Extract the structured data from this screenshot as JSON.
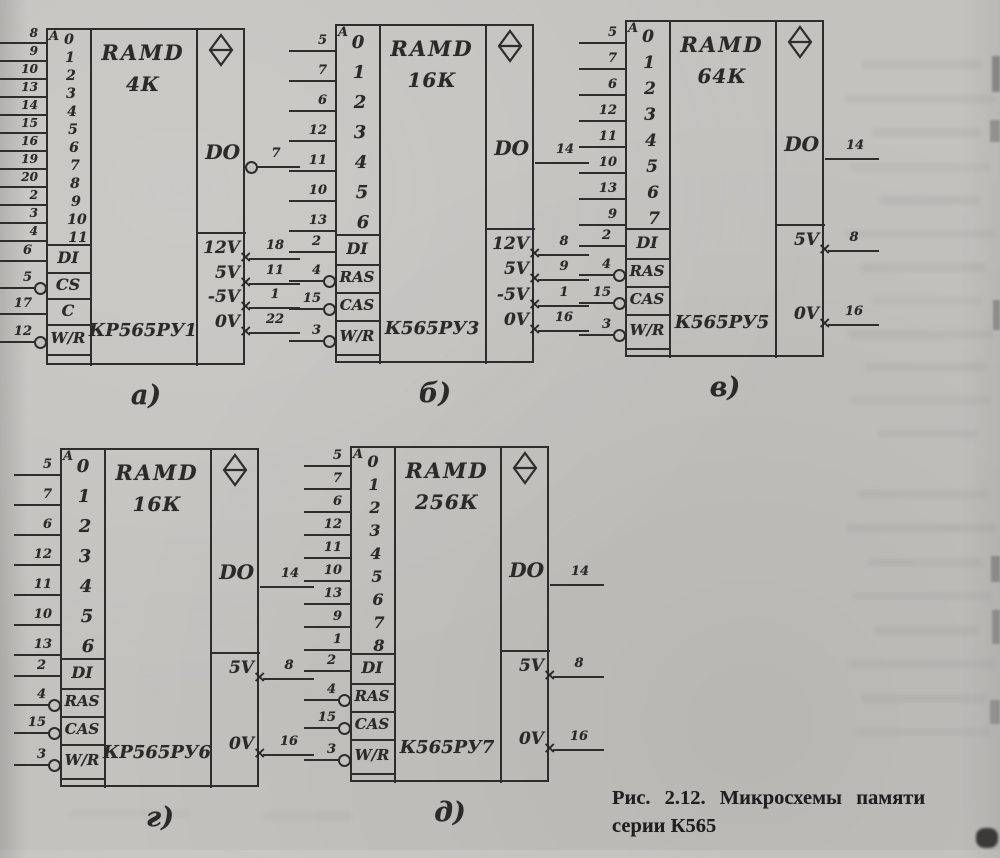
{
  "page": {
    "background_color": "#c4c2be",
    "ink_color": "#2e2d2b",
    "caption": {
      "line1": "Рис. 2.12. Микросхемы памяти",
      "line2": "серии К565"
    }
  },
  "chips": [
    {
      "id": "a",
      "label": "а)",
      "device_type": "RAMD",
      "capacity": "4К",
      "part_number": "КР565РУ1",
      "address_port_label": "A",
      "address_pins": [
        {
          "bit": "0",
          "pin": "8"
        },
        {
          "bit": "1",
          "pin": "9"
        },
        {
          "bit": "2",
          "pin": "10"
        },
        {
          "bit": "3",
          "pin": "13"
        },
        {
          "bit": "4",
          "pin": "14"
        },
        {
          "bit": "5",
          "pin": "15"
        },
        {
          "bit": "6",
          "pin": "16"
        },
        {
          "bit": "7",
          "pin": "19"
        },
        {
          "bit": "8",
          "pin": "20"
        },
        {
          "bit": "9",
          "pin": "2"
        },
        {
          "bit": "10",
          "pin": "3"
        },
        {
          "bit": "11",
          "pin": "4"
        }
      ],
      "input_pins": [
        {
          "label": "DI",
          "pin": "6",
          "inverted": false
        },
        {
          "label": "CS",
          "pin": "5",
          "inverted": true
        },
        {
          "label": "C",
          "pin": "17",
          "inverted": false
        },
        {
          "label": "W/R",
          "pin": "12",
          "inverted": true
        }
      ],
      "output_pin": {
        "label": "DO",
        "pin": "7",
        "inverted": true
      },
      "power_pins": [
        {
          "label": "12V",
          "pin": "18"
        },
        {
          "label": "5V",
          "pin": "11"
        },
        {
          "label": "-5V",
          "pin": "1"
        },
        {
          "label": "0V",
          "pin": "22"
        }
      ]
    },
    {
      "id": "b",
      "label": "б)",
      "device_type": "RAMD",
      "capacity": "16К",
      "part_number": "К565РУ3",
      "address_port_label": "A",
      "address_pins": [
        {
          "bit": "0",
          "pin": "5"
        },
        {
          "bit": "1",
          "pin": "7"
        },
        {
          "bit": "2",
          "pin": "6"
        },
        {
          "bit": "3",
          "pin": "12"
        },
        {
          "bit": "4",
          "pin": "11"
        },
        {
          "bit": "5",
          "pin": "10"
        },
        {
          "bit": "6",
          "pin": "13"
        }
      ],
      "input_pins": [
        {
          "label": "DI",
          "pin": "2",
          "inverted": false
        },
        {
          "label": "RAS",
          "pin": "4",
          "inverted": true
        },
        {
          "label": "CAS",
          "pin": "15",
          "inverted": true
        },
        {
          "label": "W/R",
          "pin": "3",
          "inverted": true
        }
      ],
      "output_pin": {
        "label": "DO",
        "pin": "14",
        "inverted": false
      },
      "power_pins": [
        {
          "label": "12V",
          "pin": "8"
        },
        {
          "label": "5V",
          "pin": "9"
        },
        {
          "label": "-5V",
          "pin": "1"
        },
        {
          "label": "0V",
          "pin": "16"
        }
      ]
    },
    {
      "id": "v",
      "label": "в)",
      "device_type": "RAMD",
      "capacity": "64К",
      "part_number": "К565РУ5",
      "address_port_label": "A",
      "address_pins": [
        {
          "bit": "0",
          "pin": "5"
        },
        {
          "bit": "1",
          "pin": "7"
        },
        {
          "bit": "2",
          "pin": "6"
        },
        {
          "bit": "3",
          "pin": "12"
        },
        {
          "bit": "4",
          "pin": "11"
        },
        {
          "bit": "5",
          "pin": "10"
        },
        {
          "bit": "6",
          "pin": "13"
        },
        {
          "bit": "7",
          "pin": "9"
        }
      ],
      "input_pins": [
        {
          "label": "DI",
          "pin": "2",
          "inverted": false
        },
        {
          "label": "RAS",
          "pin": "4",
          "inverted": true
        },
        {
          "label": "CAS",
          "pin": "15",
          "inverted": true
        },
        {
          "label": "W/R",
          "pin": "3",
          "inverted": true
        }
      ],
      "output_pin": {
        "label": "DO",
        "pin": "14",
        "inverted": false
      },
      "power_pins": [
        {
          "label": "5V",
          "pin": "8"
        },
        {
          "label": "0V",
          "pin": "16"
        }
      ]
    },
    {
      "id": "g",
      "label": "г)",
      "device_type": "RAMD",
      "capacity": "16К",
      "part_number": "КР565РУ6",
      "address_port_label": "A",
      "address_pins": [
        {
          "bit": "0",
          "pin": "5"
        },
        {
          "bit": "1",
          "pin": "7"
        },
        {
          "bit": "2",
          "pin": "6"
        },
        {
          "bit": "3",
          "pin": "12"
        },
        {
          "bit": "4",
          "pin": "11"
        },
        {
          "bit": "5",
          "pin": "10"
        },
        {
          "bit": "6",
          "pin": "13"
        }
      ],
      "input_pins": [
        {
          "label": "DI",
          "pin": "2",
          "inverted": false
        },
        {
          "label": "RAS",
          "pin": "4",
          "inverted": true
        },
        {
          "label": "CAS",
          "pin": "15",
          "inverted": true
        },
        {
          "label": "W/R",
          "pin": "3",
          "inverted": true
        }
      ],
      "output_pin": {
        "label": "DO",
        "pin": "14",
        "inverted": false
      },
      "power_pins": [
        {
          "label": "5V",
          "pin": "8"
        },
        {
          "label": "0V",
          "pin": "16"
        }
      ]
    },
    {
      "id": "d",
      "label": "д)",
      "device_type": "RAMD",
      "capacity": "256К",
      "part_number": "К565РУ7",
      "address_port_label": "A",
      "address_pins": [
        {
          "bit": "0",
          "pin": "5"
        },
        {
          "bit": "1",
          "pin": "7"
        },
        {
          "bit": "2",
          "pin": "6"
        },
        {
          "bit": "3",
          "pin": "12"
        },
        {
          "bit": "4",
          "pin": "11"
        },
        {
          "bit": "5",
          "pin": "10"
        },
        {
          "bit": "6",
          "pin": "13"
        },
        {
          "bit": "7",
          "pin": "9"
        },
        {
          "bit": "8",
          "pin": "1"
        }
      ],
      "input_pins": [
        {
          "label": "DI",
          "pin": "2",
          "inverted": false
        },
        {
          "label": "RAS",
          "pin": "4",
          "inverted": true
        },
        {
          "label": "CAS",
          "pin": "15",
          "inverted": true
        },
        {
          "label": "W/R",
          "pin": "3",
          "inverted": true
        }
      ],
      "output_pin": {
        "label": "DO",
        "pin": "14",
        "inverted": false
      },
      "power_pins": [
        {
          "label": "5V",
          "pin": "8"
        },
        {
          "label": "0V",
          "pin": "16"
        }
      ]
    }
  ]
}
